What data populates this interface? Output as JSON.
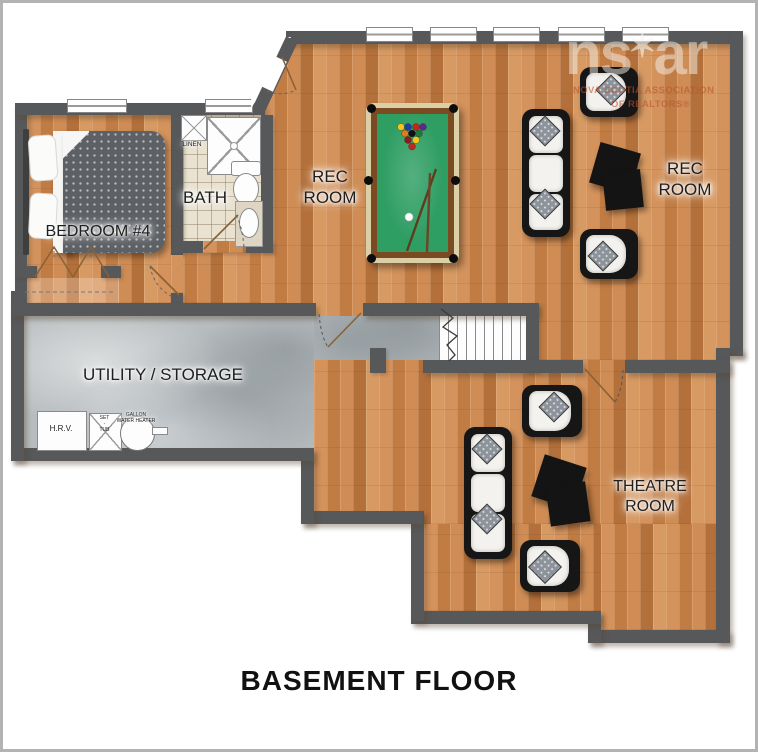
{
  "plan_title": "BASEMENT FLOOR",
  "watermark": {
    "logo_ns": "ns",
    "logo_star": "✶",
    "logo_ar": "ar",
    "assoc_line1": "NOVA SCOTIA ASSOCIATION",
    "assoc_line2": "OF REALTORS®"
  },
  "rooms": {
    "bedroom": {
      "label": "BEDROOM #4"
    },
    "bath": {
      "label": "BATH"
    },
    "linen": {
      "label": "LINEN"
    },
    "rec_room_main": {
      "line1": "REC",
      "line2": "ROOM"
    },
    "rec_room_right": {
      "line1": "REC",
      "line2": "ROOM"
    },
    "utility": {
      "label": "UTILITY / STORAGE"
    },
    "theatre": {
      "line1": "THEATRE",
      "line2": "ROOM"
    }
  },
  "fixtures": {
    "hrv": {
      "label": "H.R.V."
    },
    "set_tub": {
      "line1": "SET",
      "line2": "TUB"
    },
    "water_heater": {
      "line1": "GALLON",
      "line2": "WATER HEATER"
    }
  },
  "colors": {
    "wall": "#57585a",
    "wood_base": "#c9854f",
    "concrete": "#b7bcbe",
    "tile": "#e9e2d1",
    "pool_felt": "#2f9e63",
    "title_color": "#111111"
  }
}
